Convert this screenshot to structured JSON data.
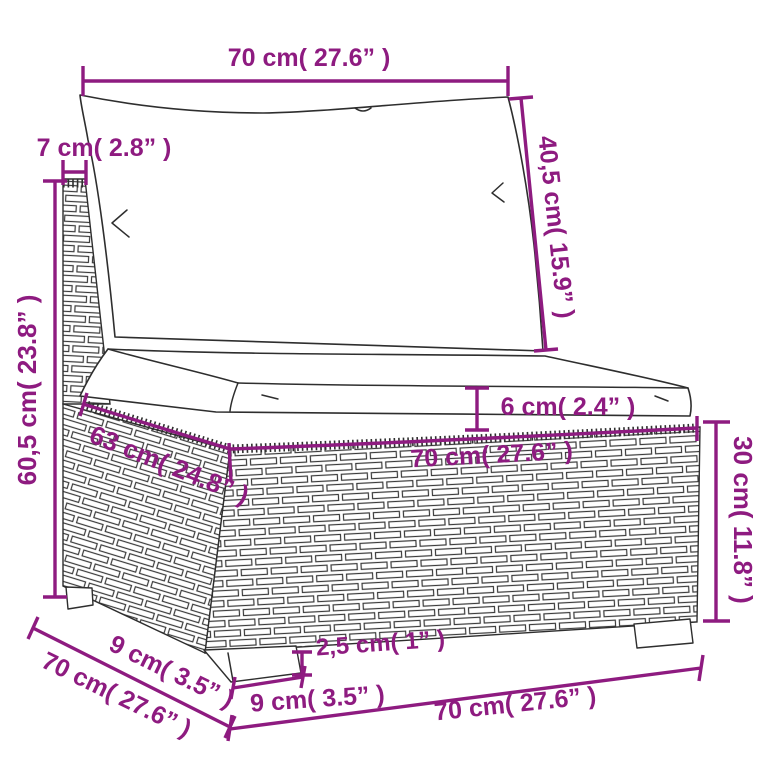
{
  "figure": {
    "kind": "furniture-dimension-diagram",
    "subject": "poly rattan middle sofa section with back cushion and seat cushion, line drawing with measurements"
  },
  "colors": {
    "dimension_accent": "#8e1b80",
    "drawing_line": "#2e2e2e",
    "background": "#ffffff"
  },
  "labels": {
    "back_width_top": "70 cm( 27.6” )",
    "frame_depth_top": "7 cm( 2.8” )",
    "back_cushion_diagonal": "40,5 cm( 15.9” )",
    "overall_height_left": "60,5 cm( 23.8” )",
    "seat_cushion_thickness": "6 cm( 2.4” )",
    "seat_top_depth": "63 cm( 24.8” )",
    "seat_top_width": "70 cm( 27.6” )",
    "base_height_right": "30 cm( 11.8” )",
    "leg_height": "2,5 cm( 1” )",
    "leg_depth_diagonal": "9 cm( 3.5” )",
    "overall_depth_diagonal": "70 cm( 27.6” )",
    "leg_width_bottom": "9 cm( 3.5” )",
    "overall_width_bottom": "70 cm( 27.6” )"
  }
}
